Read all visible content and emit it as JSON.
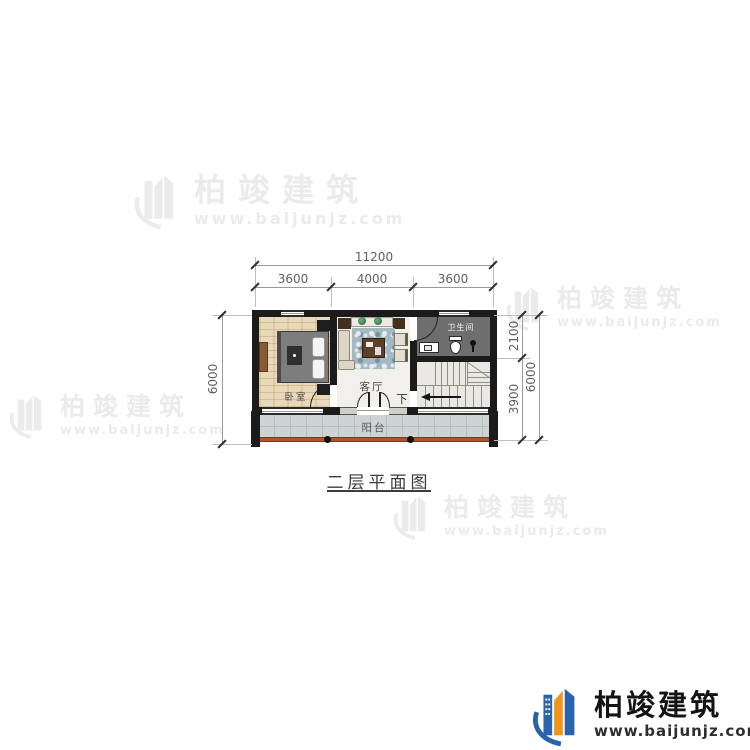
{
  "title": {
    "text": "二层平面图"
  },
  "brand": {
    "name": "柏竣建筑",
    "url": "www.baijunjz.com"
  },
  "plan": {
    "rooms": {
      "bedroom": "卧室",
      "living_room": "客厅",
      "bathroom": "卫生间",
      "balcony": "阳台",
      "stair_direction": "下"
    },
    "dimensions": {
      "top_overall": "11200",
      "top_segments": [
        "3600",
        "4000",
        "3600"
      ],
      "left_overall": "6000",
      "right_segments": [
        "2100",
        "3900"
      ],
      "right_overall": "6000"
    }
  },
  "colors": {
    "wall": "#1b1b1b",
    "bathroom_floor": "#6e6e6e",
    "balcony_railing": "#a9572f",
    "logo_blue": "#2a63ad",
    "logo_orange": "#f0941d",
    "watermark": "#ebebeb"
  }
}
